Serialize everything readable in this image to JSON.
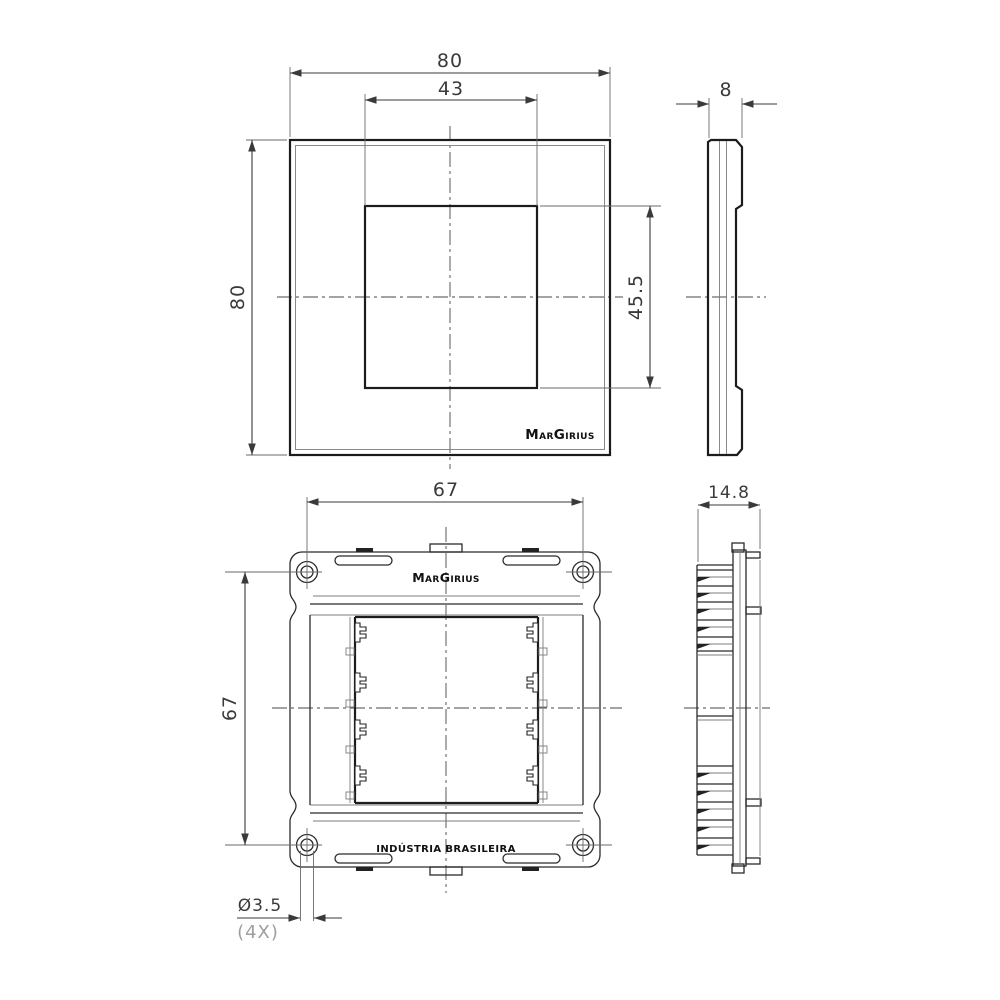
{
  "page": {
    "background": "#ffffff",
    "line_color": "#1c1c1c",
    "dim_color": "#3a3a3a",
    "muted_color": "#9e9e9e"
  },
  "views": {
    "plate_front": {
      "name": "cover plate front view",
      "dim_width": "80",
      "dim_opening_width": "43",
      "dim_height": "80",
      "dim_opening_height": "45.5",
      "logo": "MarGirius"
    },
    "plate_side": {
      "name": "cover plate side view",
      "dim_thickness": "8"
    },
    "frame_front": {
      "name": "mounting frame front view",
      "dim_width": "67",
      "dim_height": "67",
      "logo": "MarGirius",
      "origin": "INDÚSTRIA BRASILEIRA",
      "hole_diameter": "Ø3.5",
      "hole_count": "(4X)"
    },
    "frame_side": {
      "name": "mounting frame side view",
      "dim_depth": "14.8"
    }
  }
}
